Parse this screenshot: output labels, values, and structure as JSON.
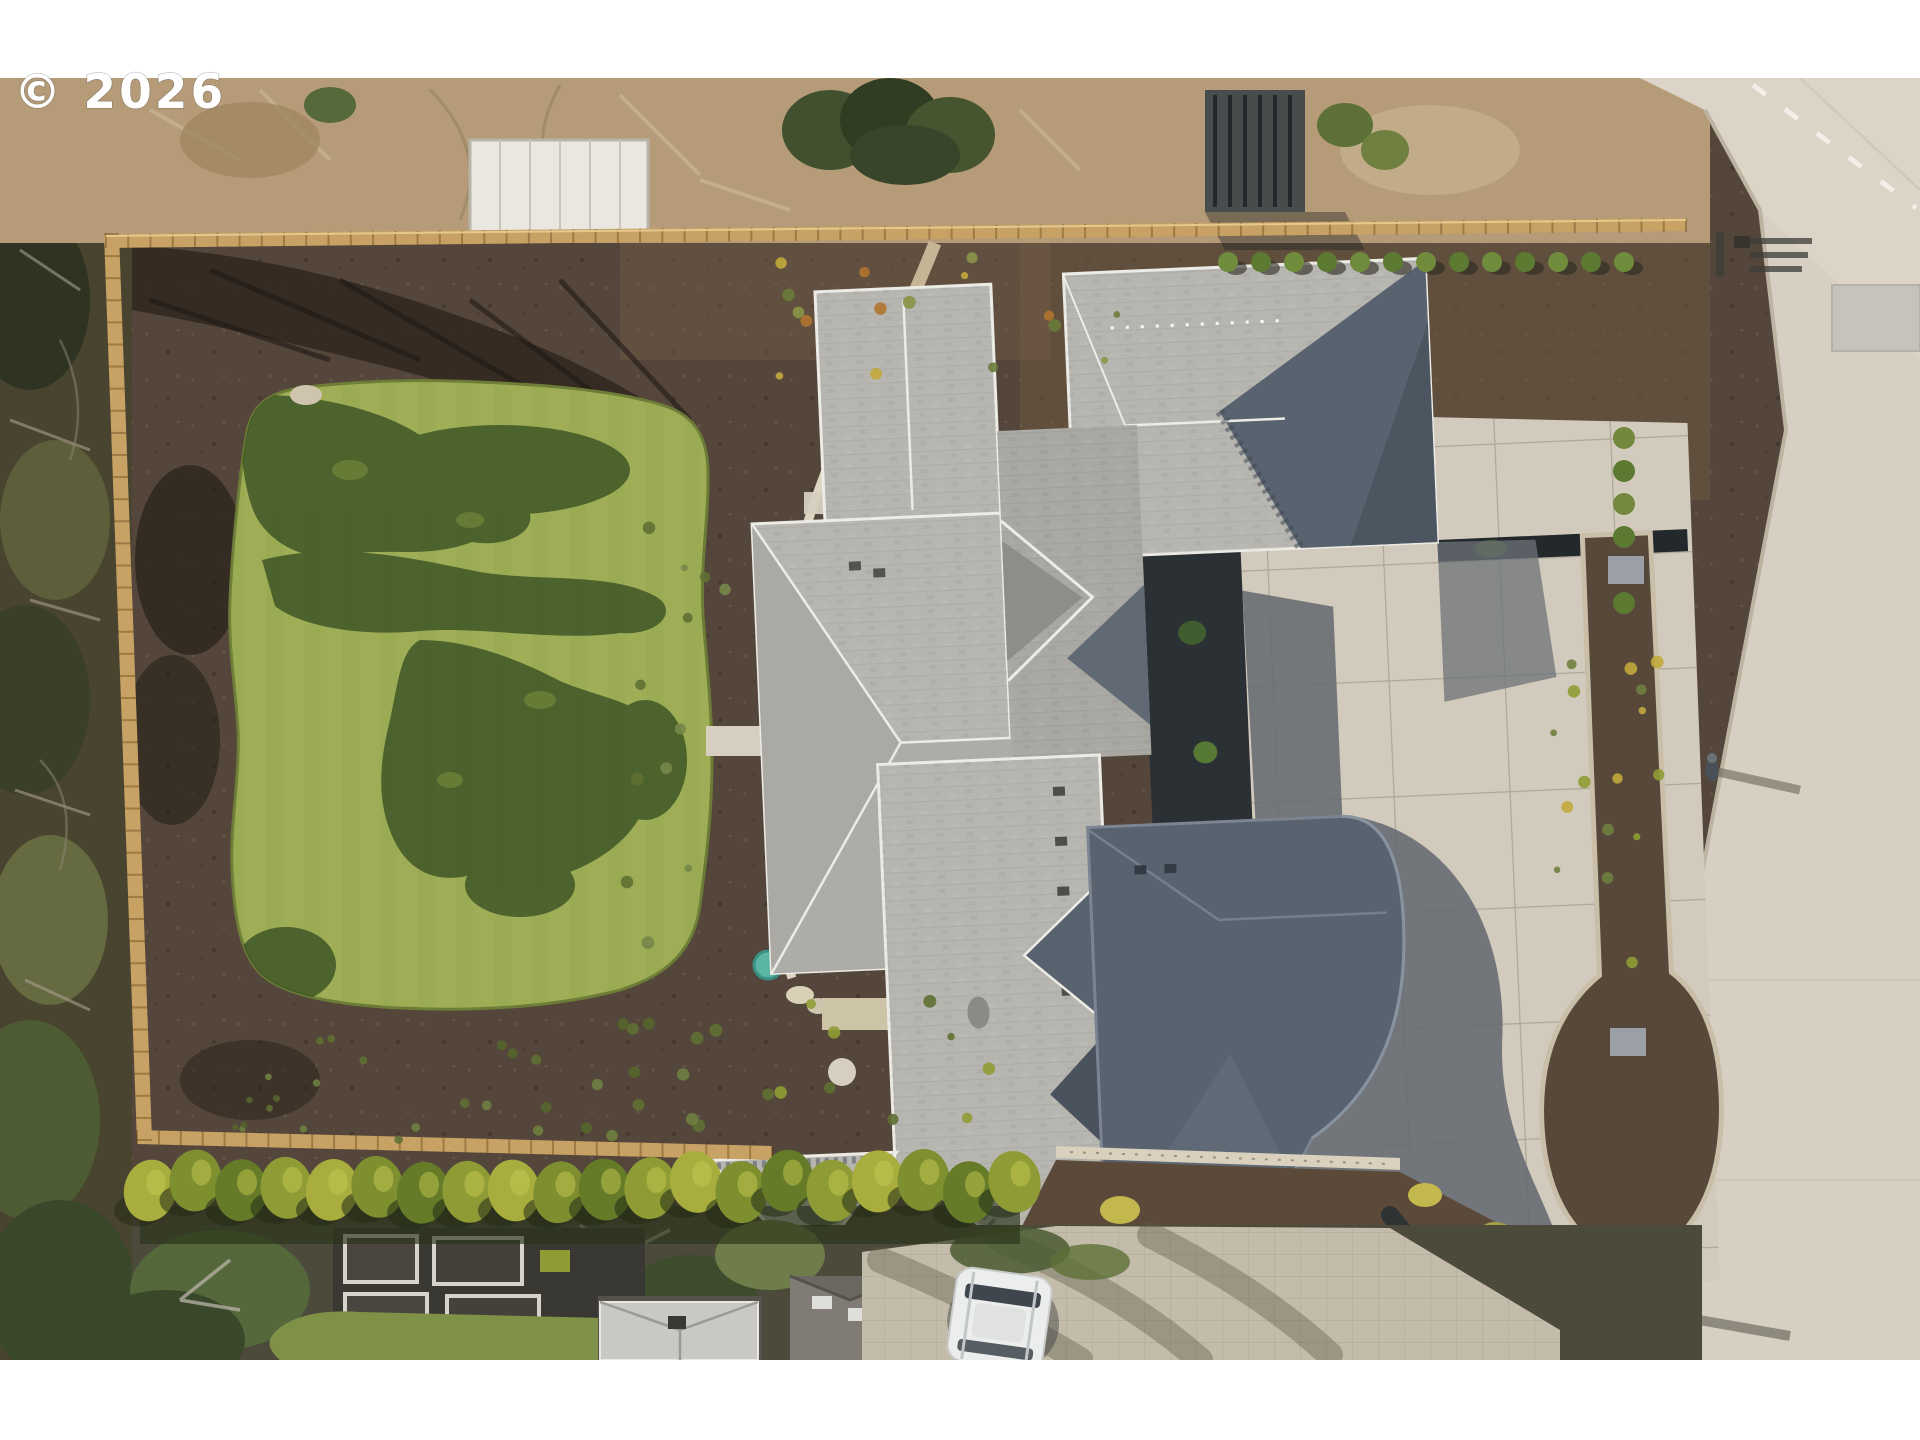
{
  "watermark": {
    "text": "© 2026"
  },
  "photo": {
    "kind": "aerial-drone-photo",
    "description": "Top-down aerial view of a newly built luxury home with a complex gray hip roof, fresh sod lawn with tree shadows, dark mulch planting beds, wooden perimeter fence, concrete motor court and driveway, neighboring yards below and a road along the right edge",
    "elements": [
      {
        "name": "copyright-watermark",
        "label": "Copyright year watermark"
      },
      {
        "name": "left-woodland",
        "label": "Wooded strip outside west fence"
      },
      {
        "name": "neighbor-top-yard",
        "label": "North neighbor dirt yard with greenhouse"
      },
      {
        "name": "perimeter-fence",
        "label": "Cedar perimeter fence"
      },
      {
        "name": "new-lawn",
        "label": "New sod lawn with tree shadows"
      },
      {
        "name": "mulch-beds",
        "label": "Dark mulch landscape beds with starter plants"
      },
      {
        "name": "main-house-roof",
        "label": "Gray composition hip roof of main house"
      },
      {
        "name": "entry-courtyard",
        "label": "Dark entry courtyard with plantings"
      },
      {
        "name": "motor-court",
        "label": "Concrete motor court in partial shadow"
      },
      {
        "name": "driveway-apron",
        "label": "Concrete driveway apron with tree well"
      },
      {
        "name": "road",
        "label": "Road with dashed centerline along right edge"
      },
      {
        "name": "pedestrian",
        "label": "Person walking on road casting long shadow"
      },
      {
        "name": "arborvitae-hedge",
        "label": "Row of arborvitae along south fence"
      },
      {
        "name": "garden-beds",
        "label": "Neighbor raised garden beds"
      },
      {
        "name": "neighbor-shed",
        "label": "Neighbor shed with gray roof"
      },
      {
        "name": "neighbor-house",
        "label": "Neighbor house roof"
      },
      {
        "name": "paver-driveway",
        "label": "Neighbor paver driveway"
      },
      {
        "name": "white-suv",
        "label": "White SUV parked on paver driveway"
      },
      {
        "name": "water-feature",
        "label": "Teal utility/water cover in backyard"
      }
    ],
    "palette": {
      "frame": "#ffffff",
      "mulch": "#54463a",
      "mulch_dark": "#2f2720",
      "lawn": "#9fae56",
      "lawn_shadow": "#3f5626",
      "woodland": "#49442f",
      "dirt_top": "#b59b77",
      "fence": "#c8a164",
      "roof_light": "#b6b5b0",
      "roof_mid": "#a9a8a2",
      "roof_shadow": "#59636f",
      "roof_shadow_deep": "#49525d",
      "eave_white": "#ecebe6",
      "concrete": "#d2cbbd",
      "road": "#d7d0c2",
      "hedge": "#7e8f30",
      "hedge_light": "#a8ad3e",
      "paver": "#c4bcaa",
      "teal": "#5ab5a5",
      "car_white": "#eceeed"
    }
  }
}
